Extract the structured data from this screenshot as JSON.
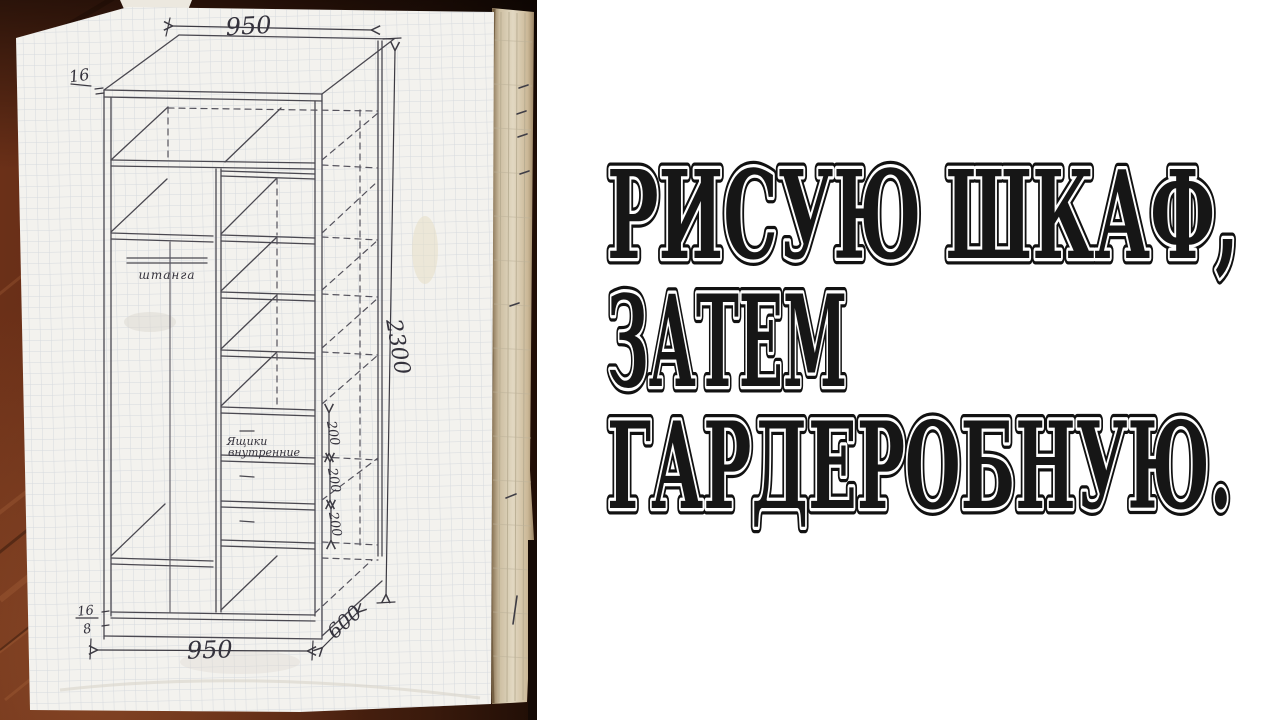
{
  "thumbnail": {
    "overlay_lines": [
      "РИСУЮ ШКАФ,",
      "ЗАТЕМ",
      "ГАРДЕРОБНУЮ."
    ]
  },
  "sketch": {
    "dim_top_width": "950",
    "dim_height": "2300",
    "dim_bottom_width": "950",
    "dim_depth": "600",
    "dim_drawer_1": "200",
    "dim_drawer_2": "200",
    "dim_drawer_3": "200",
    "thickness_top": "16",
    "thickness_base_top": "16",
    "thickness_base_bottom": "8",
    "label_rod": "штанга",
    "label_drawers_1": "Ящики",
    "label_drawers_2": "внутренние"
  },
  "colors": {
    "wood_dark": "#200e06",
    "wood_mid": "#5a2713",
    "wood_light": "#a05a32",
    "paper": "#f3f2ee",
    "grid_line": "#c3c9d4",
    "curl_page": "#e2d8c2",
    "ink": "#4a4850",
    "overlay_text": "#161616",
    "overlay_outline": "#ffffff",
    "background": "#ffffff"
  }
}
